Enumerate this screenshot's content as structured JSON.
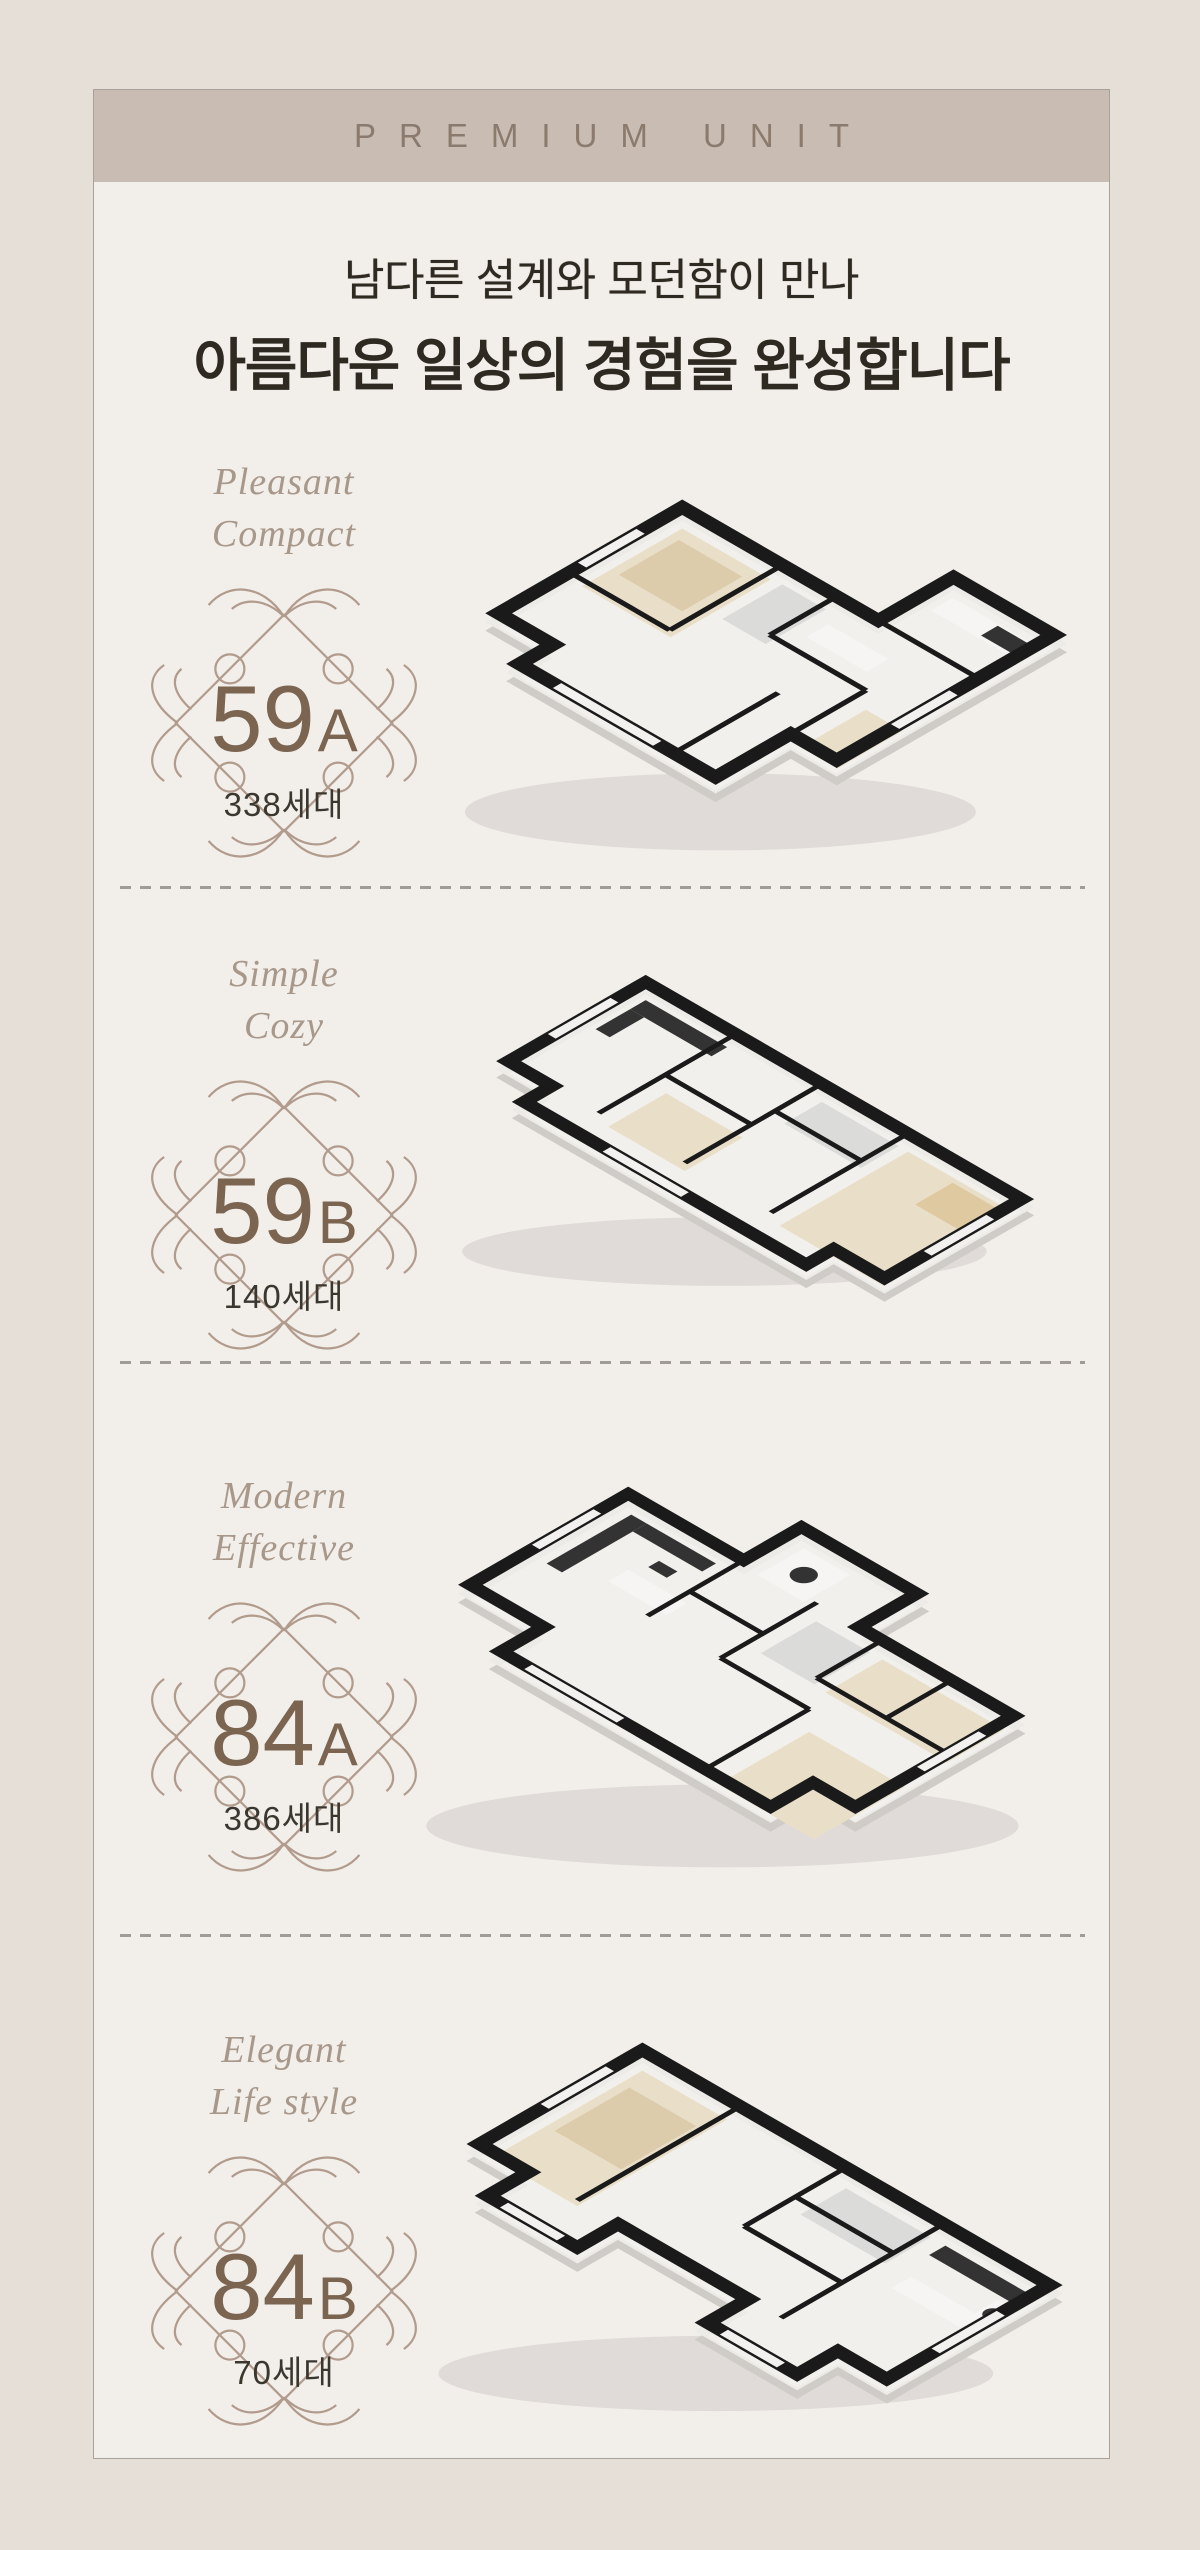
{
  "header": {
    "label": "PREMIUM UNIT"
  },
  "title": {
    "line1": "남다른 설계와 모던함이 만나",
    "line2": "아름다운 일상의 경험을 완성합니다"
  },
  "units": [
    {
      "id": "59A",
      "tagline1": "Pleasant",
      "tagline2": "Compact",
      "number": "59",
      "letter": "A",
      "households": "338세대"
    },
    {
      "id": "59B",
      "tagline1": "Simple",
      "tagline2": "Cozy",
      "number": "59",
      "letter": "B",
      "households": "140세대"
    },
    {
      "id": "84A",
      "tagline1": "Modern",
      "tagline2": "Effective",
      "number": "84",
      "letter": "A",
      "households": "386세대"
    },
    {
      "id": "84B",
      "tagline1": "Elegant",
      "tagline2": "Life style",
      "number": "84",
      "letter": "B",
      "households": "70세대"
    }
  ],
  "colors": {
    "outer_bg": "#e6dfd8",
    "panel_bg": "#f2eeea",
    "band_bg": "#c9bcb2",
    "band_text": "#8b7a6e",
    "title_text": "#2e2921",
    "script_text": "#a8988a",
    "ornament": "#b19b8c",
    "unit_number": "#7b6551",
    "households_text": "#3a372f",
    "divider": "#a09b95",
    "wall_top": "#1a1a1a"
  }
}
